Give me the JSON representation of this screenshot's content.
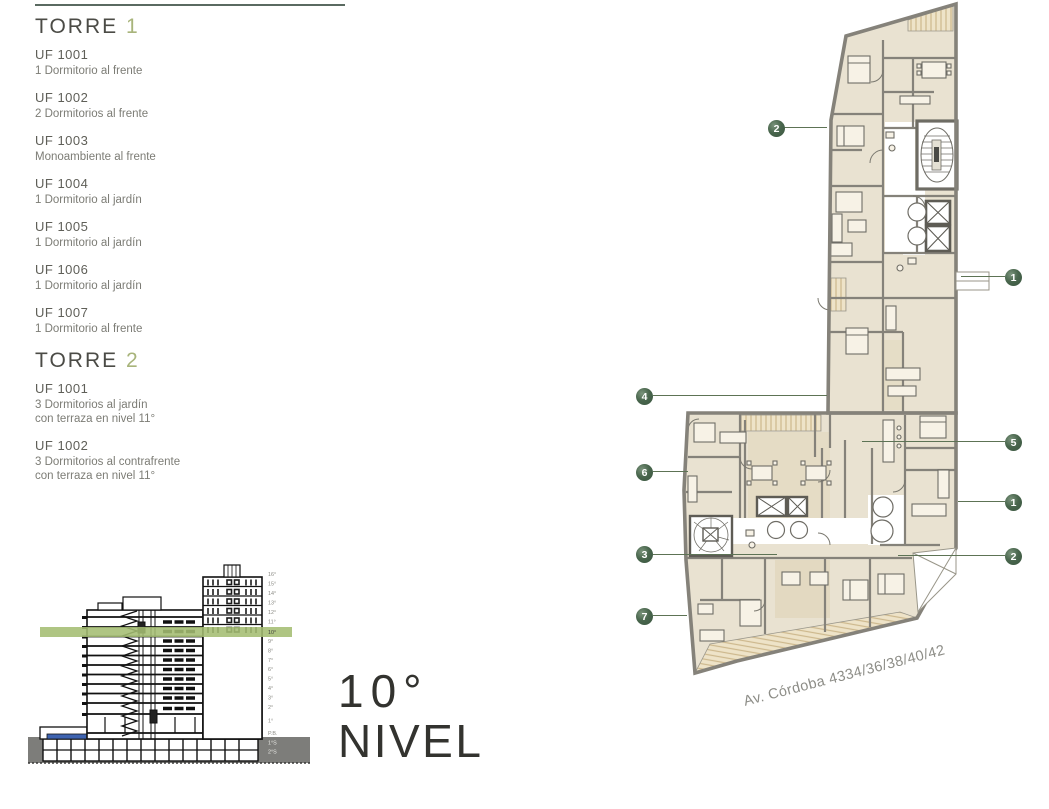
{
  "listing": {
    "torre1": {
      "title": "TORRE",
      "number": "1",
      "units": [
        {
          "code": "UF 1001",
          "desc": "1 Dormitorio al frente"
        },
        {
          "code": "UF 1002",
          "desc": "2 Dormitorios al frente"
        },
        {
          "code": "UF 1003",
          "desc": "Monoambiente al frente"
        },
        {
          "code": "UF 1004",
          "desc": "1 Dormitorio al jardín"
        },
        {
          "code": "UF 1005",
          "desc": "1 Dormitorio al jardín"
        },
        {
          "code": "UF 1006",
          "desc": "1 Dormitorio al jardín"
        },
        {
          "code": "UF 1007",
          "desc": "1 Dormitorio al frente"
        }
      ]
    },
    "torre2": {
      "title": "TORRE",
      "number": "2",
      "units": [
        {
          "code": "UF 1001",
          "desc": "3 Dormitorios al jardín",
          "desc2": "con terraza en nivel 11°"
        },
        {
          "code": "UF 1002",
          "desc": "3 Dormitorios al contrafrente",
          "desc2": "con terraza en nivel 11°"
        }
      ]
    }
  },
  "level_title": {
    "number": "10°",
    "word": "NIVEL"
  },
  "section": {
    "levels": [
      "16°",
      "15°",
      "14°",
      "13°",
      "12°",
      "11°",
      "10°",
      "9°",
      "8°",
      "7°",
      "6°",
      "5°",
      "4°",
      "3°",
      "2°",
      "1°",
      "P.B.",
      "1°S",
      "2°S"
    ],
    "highlighted_level": "10°",
    "band_color": "#a4bd72",
    "pool_color": "#3e63b0"
  },
  "plan": {
    "street_label": "Av. Córdoba 4334/36/38/40/42",
    "marker_color": "#41603f",
    "markers": [
      {
        "n": "2"
      },
      {
        "n": "1"
      },
      {
        "n": "4"
      },
      {
        "n": "5"
      },
      {
        "n": "6"
      },
      {
        "n": "1"
      },
      {
        "n": "3"
      },
      {
        "n": "2"
      },
      {
        "n": "7"
      }
    ]
  }
}
